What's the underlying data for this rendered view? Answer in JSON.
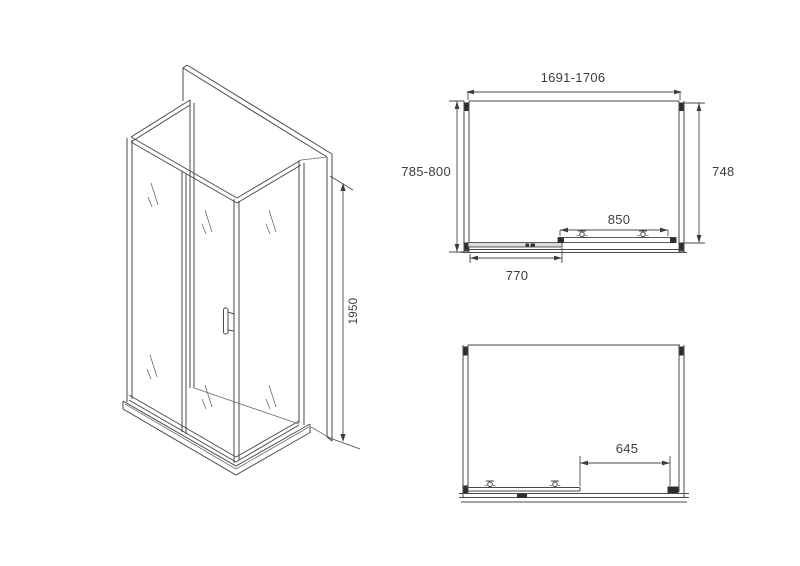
{
  "page": {
    "background": "#ffffff"
  },
  "colors": {
    "line": "#4a4a4a",
    "dark_fill": "#2e2e2e",
    "text": "#3d3d3d"
  },
  "iso_view": {
    "height_label": "1950"
  },
  "plan_view": {
    "width_label": "1691-1706",
    "depth_left_label": "785-800",
    "depth_right_label": "748",
    "door_width_label": "850",
    "opening_width_label": "770"
  },
  "front_view": {
    "door_travel_label": "645"
  }
}
